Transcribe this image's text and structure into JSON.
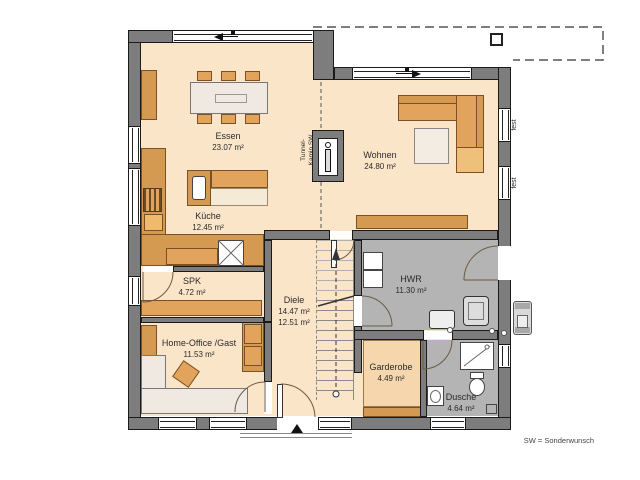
{
  "rooms": {
    "essen": {
      "name": "Essen",
      "area": "23.07 m²"
    },
    "wohnen": {
      "name": "Wohnen",
      "area": "24.80 m²"
    },
    "kueche": {
      "name": "Küche",
      "area": "12.45 m²"
    },
    "spk": {
      "name": "SPK",
      "area": "4.72 m²"
    },
    "diele": {
      "name": "Diele",
      "area": "14.47 m²",
      "area2": "12.51 m²"
    },
    "hwr": {
      "name": "HWR",
      "area": "11.30 m²"
    },
    "homeoffice": {
      "name": "Home-Office /Gast",
      "area": "11.53 m²"
    },
    "garderobe": {
      "name": "Garderobe",
      "area": "4.49 m²"
    },
    "dusche": {
      "name": "Dusche",
      "area": "4.64 m²"
    }
  },
  "annotations": {
    "kamin_line1": "Tunnel-",
    "kamin_line2": "Kamin SW",
    "window_fixed_top": "fest",
    "window_fixed_bottom": "fest",
    "legend": "SW = Sonderwunsch"
  },
  "colors": {
    "wall": "#7d7d7d",
    "floor": "#fbe5c9",
    "floor_utility": "#b4b4b4",
    "furniture": "#e2a45c",
    "furniture_dark": "#d59a52",
    "garderobe_block": "#f6d7ad",
    "line": "#1a1a1a"
  }
}
